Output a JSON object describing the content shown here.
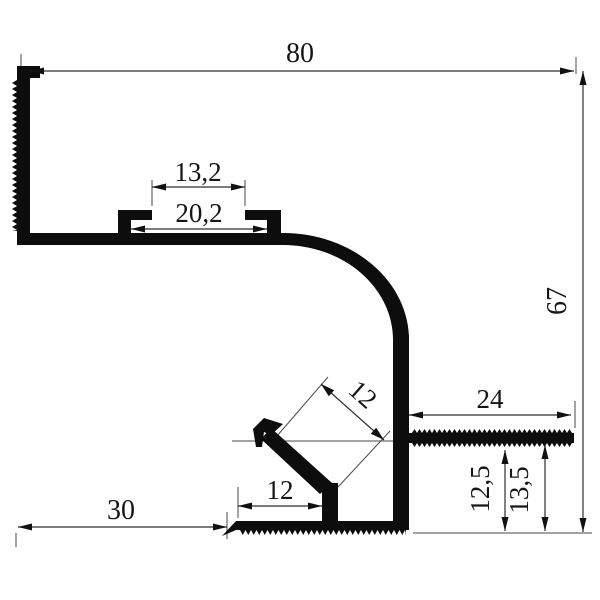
{
  "drawing": {
    "kind": "profile-cross-section-dimension-drawing",
    "dimensions": {
      "top_width": "80",
      "right_height": "67",
      "channel_opening": "13,2",
      "channel_width": "20,2",
      "flange_length": "24",
      "diagonal_arm": "12",
      "flange_to_bottom_inner": "12,5",
      "flange_to_bottom_outer": "13,5",
      "base_offset": "12",
      "left_gap": "30"
    },
    "colors": {
      "profile_fill": "#0d0d0d",
      "dimension_line": "#2f2f2f",
      "text": "#161616",
      "background": "#ffffff"
    }
  }
}
